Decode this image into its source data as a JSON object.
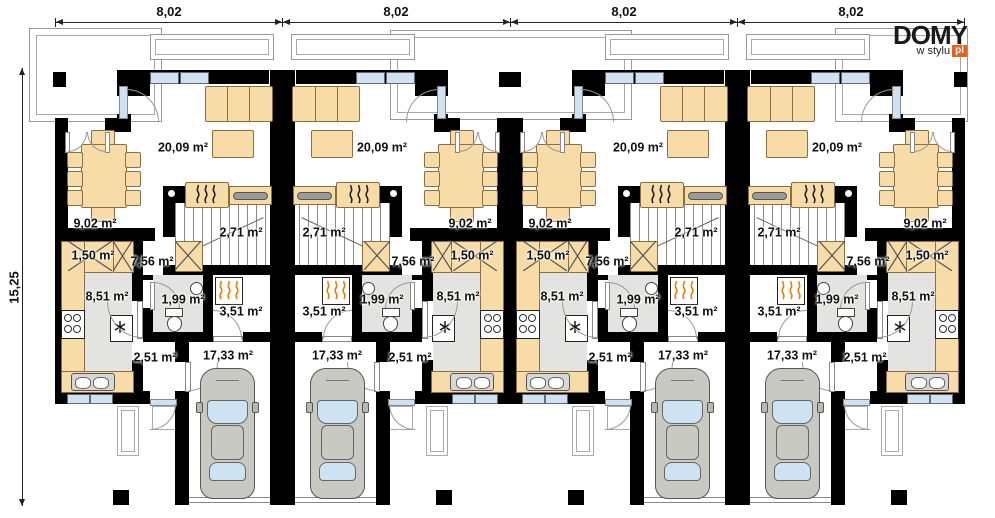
{
  "logo": {
    "name": "DOMY",
    "tagline": "w stylu",
    "suffix": "pl"
  },
  "dimensions": {
    "top": [
      "8,02",
      "8,02",
      "8,02",
      "8,02"
    ],
    "left": "15,25"
  },
  "rooms": {
    "living": "20,09 m²",
    "dining": "9,02 m²",
    "wardrobe": "1,50 m²",
    "hall": "7,56 m²",
    "stairs": "2,71 m²",
    "kitchen": "8,51 m²",
    "wc": "1,99 m²",
    "utility": "3,51 m²",
    "vestibule": "2,51 m²",
    "garage": "17,33 m²"
  },
  "units": [
    {
      "id": "unit-1",
      "left": 55,
      "mirrored": false
    },
    {
      "id": "unit-2",
      "left": 282,
      "mirrored": true
    },
    {
      "id": "unit-3",
      "left": 510,
      "mirrored": false
    },
    {
      "id": "unit-4",
      "left": 737,
      "mirrored": true
    }
  ],
  "colors": {
    "wall": "#000000",
    "furniture": "#f8dca8",
    "furniture_border": "#8a6f45",
    "window_glass": "#cfe2f2",
    "floor_gray": "#e3e3e1",
    "car_body": "#c9c9c3",
    "car_glass": "#cde3f3",
    "flame_orange": "#f07c00",
    "logo_orange": "#e8611c"
  }
}
